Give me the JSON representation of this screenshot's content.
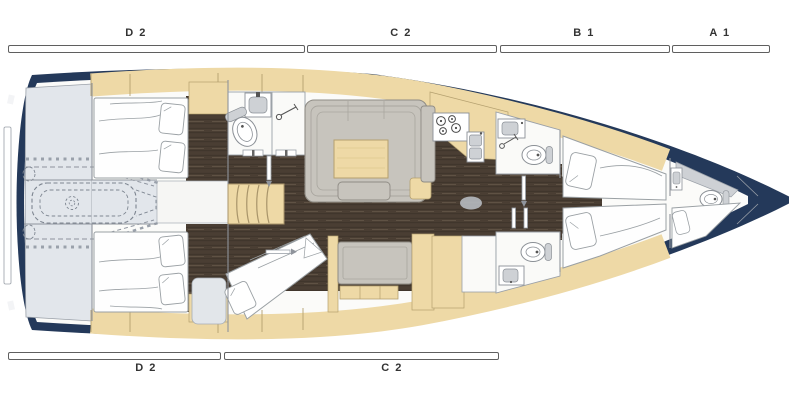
{
  "title": "Sailing yacht interior layout plan",
  "dimension_labels": {
    "top": [
      {
        "label": "D 2"
      },
      {
        "label": "C 2"
      },
      {
        "label": "B 1"
      },
      {
        "label": "A 1"
      }
    ],
    "bottom": [
      {
        "label": "D 2"
      },
      {
        "label": "C 2"
      }
    ]
  },
  "icons": {
    "toilet": "ellipse-with-ring",
    "sink": "rect-with-basin",
    "shower": "showerhead-circle-with-arm",
    "stove": "four-burner-circles",
    "stairs": "curved-treads",
    "engine": "dashed-rounded-outline"
  },
  "colors": {
    "hull_navy": "#24395a",
    "interior_white": "#fbfbf9",
    "deck_tan": "#eed9a6",
    "tan_outline": "#b4a06f",
    "wood_dark": "#4a3e33",
    "wood_seam": "#362d25",
    "wood_streak": "#5f5244",
    "garage_gray": "#e2e6eb",
    "upholstery_gray": "#c7c4bd",
    "upholstery_line": "#8f8c85",
    "upholstery_seam": "#a9a69f",
    "fixture_gray": "#ced1d5",
    "fixture_line": "#8b9096",
    "room_white": "#fafaf8",
    "outline_gray": "#9aa0a8",
    "bed_line": "#9aa0a4",
    "machinery_dash": "#8d939e",
    "machinery_dot": "#9aa1ab",
    "label_text": "#333333",
    "bar_border": "#5f5f5f",
    "floor_mat": "#b6bac0",
    "stair_line": "#a8946a"
  }
}
